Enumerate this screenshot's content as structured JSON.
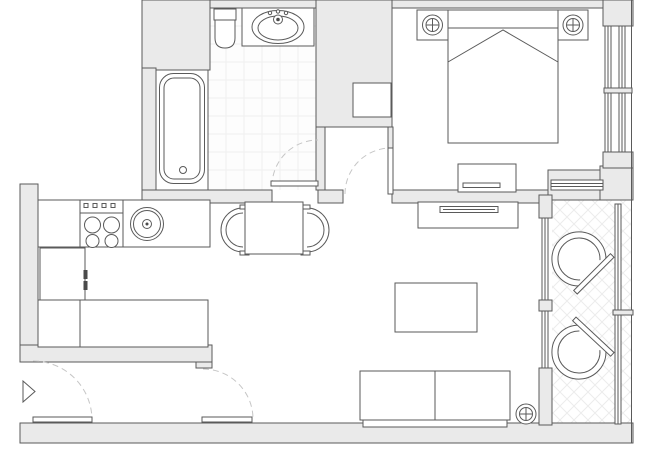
{
  "figure": {
    "type": "floor-plan",
    "canvas": {
      "width": 650,
      "height": 450
    },
    "colors": {
      "wall_fill": "#eaeaea",
      "line": "#5a5a5a",
      "tile_line": "#f0f0f0",
      "hatch_line": "#ececec",
      "door_arc": "#c6c6c6",
      "dark_accent": "#4a4a4a",
      "floor": "#ffffff"
    },
    "rooms": [
      {
        "name": "bathroom",
        "floor": "tiled-grid",
        "furniture": [
          "bathtub",
          "toilet",
          "vanity",
          "oval-sink"
        ]
      },
      {
        "name": "bedroom",
        "floor": "plain",
        "furniture": [
          "double-bed",
          "headboard",
          "nightstand-left",
          "nightstand-right",
          "lamp-symbol-left",
          "lamp-symbol-right",
          "dresser",
          "shaft-box"
        ]
      },
      {
        "name": "kitchen",
        "floor": "plain",
        "furniture": [
          "counter-top",
          "stove-4-burner",
          "round-sink",
          "refrigerator",
          "counter-lower-l"
        ]
      },
      {
        "name": "dining",
        "floor": "plain",
        "furniture": [
          "square-table",
          "half-round-chair-left",
          "half-round-chair-right"
        ]
      },
      {
        "name": "living-room",
        "floor": "plain",
        "furniture": [
          "tv-cabinet",
          "tv",
          "coffee-table",
          "sofa-two-seat",
          "lamp-symbol"
        ]
      },
      {
        "name": "balcony",
        "floor": "diagonal-crosshatch",
        "furniture": [
          "fan-chair-top",
          "fan-chair-bottom"
        ]
      },
      {
        "name": "entry-hall",
        "floor": "plain",
        "furniture": [
          "entrance-marker-triangle"
        ]
      }
    ],
    "doors": [
      {
        "name": "bathroom-door",
        "style": "quarter-arc-dashed"
      },
      {
        "name": "bedroom-door",
        "style": "quarter-arc-dashed"
      },
      {
        "name": "hall-door-left",
        "style": "quarter-arc-dashed"
      },
      {
        "name": "hall-door-right",
        "style": "quarter-arc-dashed"
      }
    ],
    "windows": [
      "bedroom-right-double-window",
      "bedroom-balcony-transom-window",
      "balcony-right-window",
      "living-balcony-glazing-upper",
      "living-balcony-glazing-lower"
    ]
  }
}
